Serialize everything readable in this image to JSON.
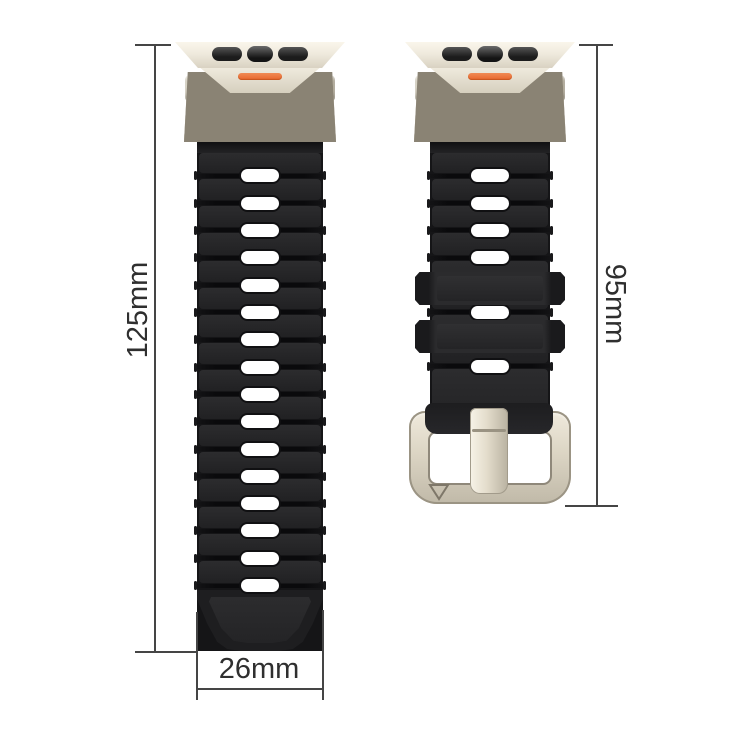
{
  "image": {
    "type": "watch-band-dimension-diagram",
    "background": "#FFFFFF"
  },
  "annotations": {
    "line_color": "#454545",
    "text_color": "#2F2F2F",
    "long_strap_length_label": "125mm",
    "short_strap_length_label": "95mm",
    "strap_width_label": "26mm"
  },
  "product": {
    "colors": {
      "strap_silicone": "#232325",
      "connector_titanium": "#E8E2D3",
      "accent_orange": "#ED7038",
      "slot_hole": "#FFFFFF",
      "buckle_titanium": "#E5DFD0"
    },
    "straps": {
      "long": {
        "slot_count": 16
      },
      "short": {
        "upper_slot_count": 4,
        "middle_slot_count": 1,
        "lower_slot_count": 1,
        "keeper_count": 2
      }
    },
    "buckle": {
      "engraving": "down-triangle"
    }
  }
}
